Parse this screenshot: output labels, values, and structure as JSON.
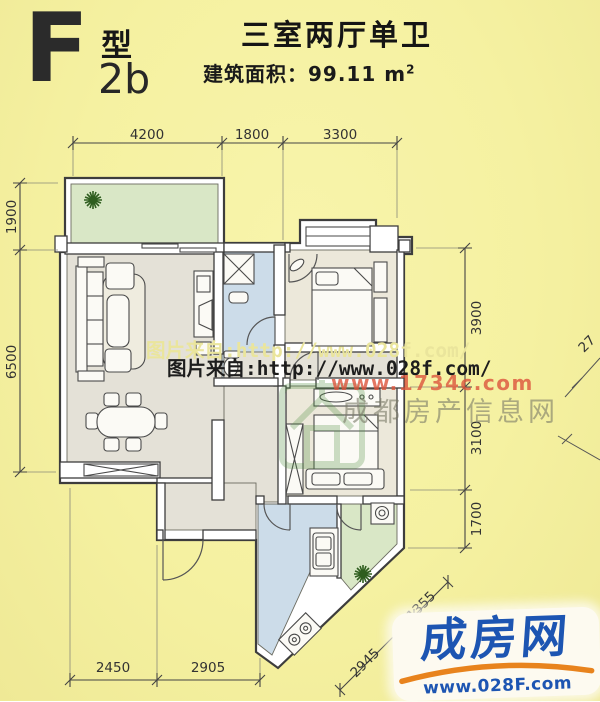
{
  "header": {
    "type_letter": "F",
    "type_word": "型",
    "type_code": "2b",
    "title": "三室两厅单卫",
    "area_label": "建筑面积：99.11 m",
    "area_exponent": "2"
  },
  "dimensions": {
    "top": [
      "4200",
      "1800",
      "3300"
    ],
    "left": [
      "1900",
      "6500"
    ],
    "right": [
      "3900",
      "3100",
      "1700"
    ],
    "bottom": [
      "2450",
      "2905"
    ],
    "diagonal": [
      "2945",
      "1355"
    ],
    "adjacent_fragment": "27"
  },
  "watermarks": {
    "ghost_text": "图片来自:http://www.028f.com/",
    "main_text": "图片来自:http://www.028f.com/",
    "red_url": "www.1734c.com",
    "gray_text": "成都房产信息网"
  },
  "logo": {
    "brand": "成房网",
    "url": "www.028F.com"
  },
  "colors": {
    "background": "#f5f1a1",
    "balcony_green": "#d9e7c6",
    "wet_area_blue": "#ccdce9",
    "floor_gray": "#e4e1d7",
    "floor_beige": "#ece8da",
    "wall_outline": "#3d3d3d",
    "logo_blue": "#1d55b2",
    "logo_orange": "#e8831d",
    "watermark_red": "#dc543c"
  }
}
